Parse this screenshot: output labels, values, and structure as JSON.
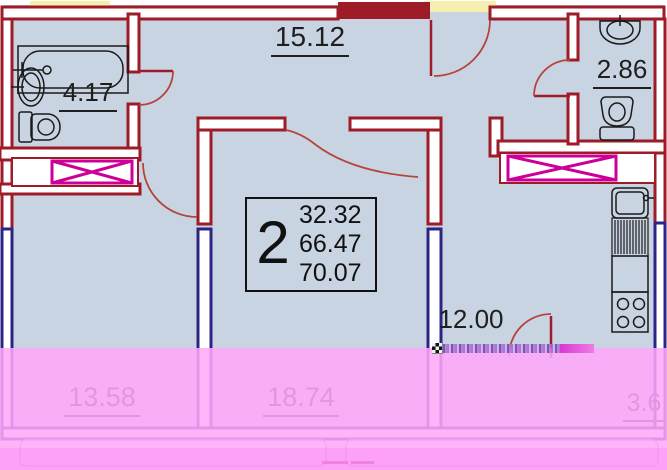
{
  "plan_title": "2-room apartment floor plan",
  "info_box": {
    "room_count": "2",
    "living_area": "32.32",
    "total_area": "66.47",
    "total_with_balcony": "70.07"
  },
  "rooms": {
    "hallway": {
      "area": "15.12"
    },
    "bathroom": {
      "area": "4.17"
    },
    "wc": {
      "area": "2.86"
    },
    "kitchen": {
      "area": "12.00"
    },
    "bedroom": {
      "area": "13.58"
    },
    "living_room": {
      "area": "18.74"
    },
    "balcony": {
      "area": "3.6"
    }
  },
  "icons": [
    "bathtub-icon",
    "bathroom-sink-icon",
    "bathroom-toilet-icon",
    "wc-sink-icon",
    "wc-toilet-icon",
    "kitchen-sink-icon",
    "kitchen-drainboard-icon",
    "kitchen-counter-icon",
    "kitchen-stove-icon",
    "closet-cross-icon"
  ],
  "colors": {
    "wall_red": "#9e1b28",
    "door_arc_red": "#b5443c",
    "window_wall_blue": "#2b2484",
    "room_fill": "#c9d4e2",
    "closet_cross_magenta": "#cc0099",
    "exterior_yellow": "#f6efad",
    "overlay_pink": "#ffa8f8",
    "overlay_pink_dark": "#f676ee",
    "label_text": "#1f1f1f"
  }
}
